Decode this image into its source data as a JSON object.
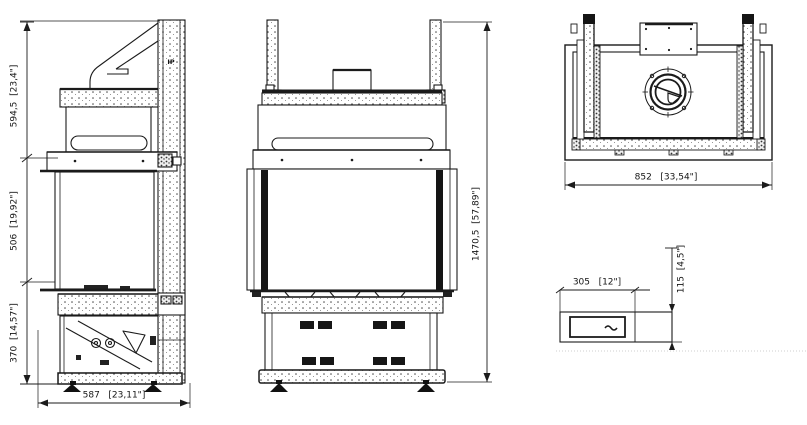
{
  "views": {
    "side": {
      "marker": "IP",
      "dims": {
        "upper": "594,5  [23,4\"]",
        "middle": "506  [19,92\"]",
        "lower": "370  [14,57\"]",
        "depth": "587   [23,11\"]"
      }
    },
    "front": {
      "dims": {
        "height": "1470,5  [57,89\"]"
      }
    },
    "top": {
      "dims": {
        "width": "852   [33,54\"]"
      }
    },
    "control_panel": {
      "dims": {
        "width": "305   [12\"]",
        "height": "115  [4,5\"]"
      }
    }
  }
}
